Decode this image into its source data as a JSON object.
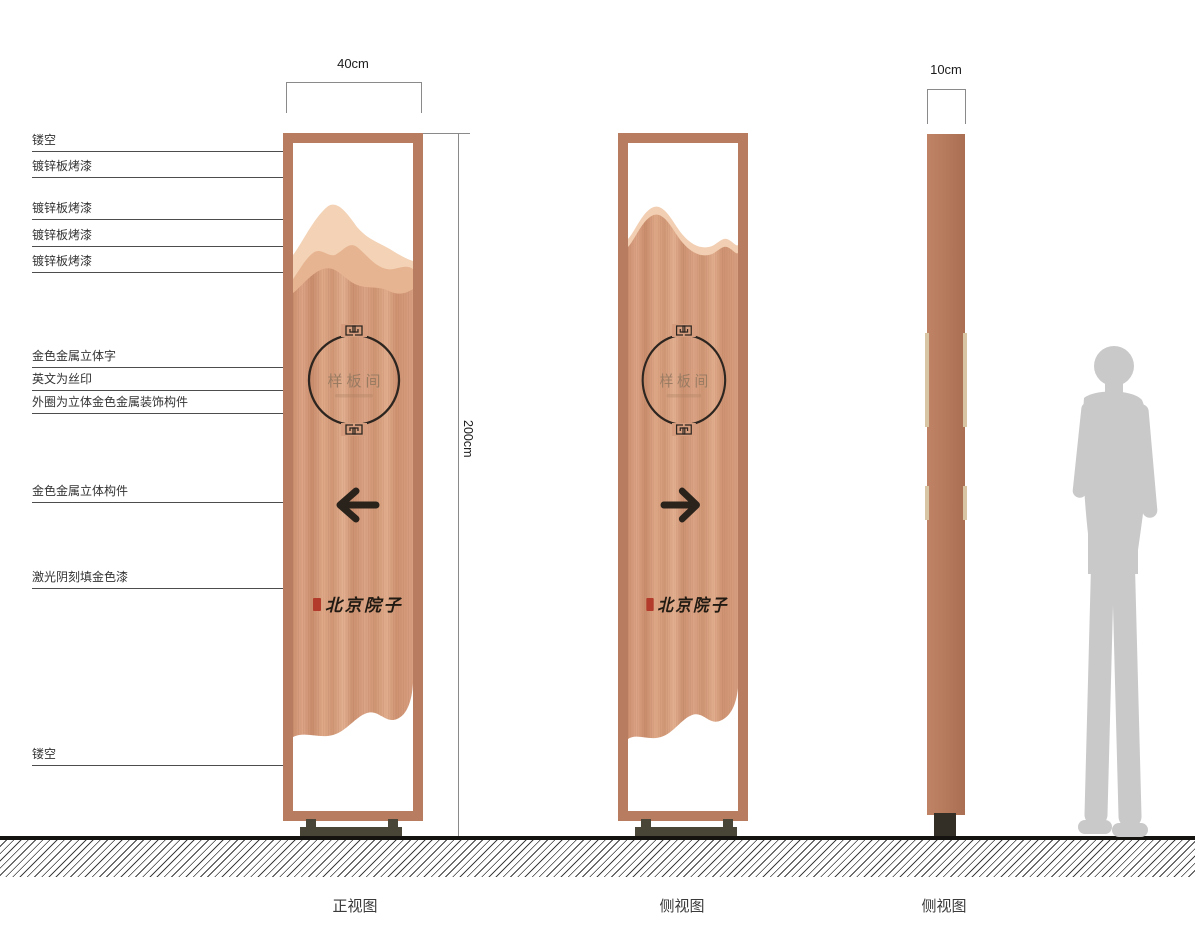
{
  "dims": {
    "front_width": "40cm",
    "height": "200cm",
    "side_width": "10cm"
  },
  "callouts": [
    {
      "text": "镂空"
    },
    {
      "text": "镀锌板烤漆"
    },
    {
      "text": "镀锌板烤漆"
    },
    {
      "text": "镀锌板烤漆"
    },
    {
      "text": "镀锌板烤漆"
    },
    {
      "text": "金色金属立体字"
    },
    {
      "text": "英文为丝印"
    },
    {
      "text": "外圈为立体金色金属装饰构件"
    },
    {
      "text": "金色金属立体构件"
    },
    {
      "text": "激光阴刻填金色漆"
    },
    {
      "text": "镂空"
    }
  ],
  "views": {
    "front": {
      "caption": "正视图",
      "emblem_text": "样板间",
      "brand_text": "北京院子",
      "arrow": "left"
    },
    "side1": {
      "caption": "侧视图",
      "emblem_text": "样板间",
      "brand_text": "北京院子",
      "arrow": "right"
    },
    "side2": {
      "caption": "侧视图"
    }
  },
  "colors": {
    "frame": "#b87c61",
    "panel_brushed": "#d59d7d",
    "mountain_light": "#f3d2b5",
    "mountain_mid": "#e7b491",
    "emblem_dark": "#2c2520",
    "seal_red": "#b33b2b",
    "base_olive": "#494637",
    "person_gray": "#c9c9c9"
  }
}
